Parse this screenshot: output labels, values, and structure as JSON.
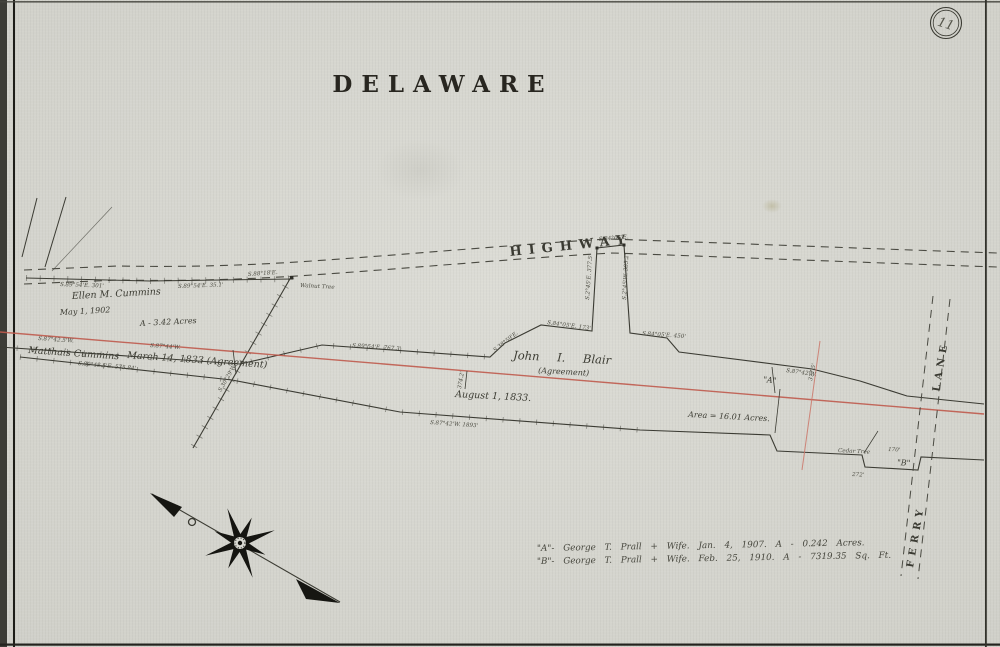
{
  "sheet": {
    "number": "11",
    "title": "DELAWARE"
  },
  "roads": {
    "highway": "HIGHWAY",
    "ferry": "FERRY",
    "lane": "LANE"
  },
  "parcels": {
    "ellen": {
      "name": "Ellen M. Cummins",
      "date": "May 1, 1902",
      "area": "A - 3.42 Acres"
    },
    "matthais": {
      "name": "Matthais Cummins",
      "date": "March 14, 1833 (Agreement)"
    },
    "blair": {
      "name": "John I. Blair",
      "agreement": "(Agreement)",
      "date": "August 1, 1833.",
      "area": "Area = 16.01 Acres."
    },
    "a_label": "\"A\"",
    "b_label": "\"B\""
  },
  "landmarks": {
    "walnut": "Walnut Tree",
    "cedar": "Cedar Tree"
  },
  "bearings": {
    "b1": "S.89°54'E.  301'",
    "b2": "S.89°54'E.  35.1'",
    "b3": "S.87°42.5'W.",
    "b4": "S.87°44'W.",
    "b5": "S.80°48.5'E.  575.84'",
    "b6": "S.89°54'E.  767.3'",
    "b7": "S.38°59'E.",
    "b8": "S.84°05'E.  173'",
    "b9": "S.2°45'E.  377.5'",
    "b10": "S.2°45'W.  385.2'",
    "b11": "S.84°05'E.",
    "b12": "S.84°05'E.  450'",
    "b13": "S.87°42'W.  1893'",
    "b14": "S.87°42'W.",
    "b15": "377.5'",
    "b16": "170'",
    "b17": "272'",
    "b18": "374.2'",
    "b19": "S.88°18'E.",
    "b20": "S.30°29'W."
  },
  "notes": {
    "a": "\"A\"- George T. Prall + Wife.  Jan. 4, 1907.  A - 0.242 Acres.",
    "b": "\"B\"- George T. Prall + Wife.  Feb. 25, 1910.  A - 7319.35 Sq. Ft."
  }
}
